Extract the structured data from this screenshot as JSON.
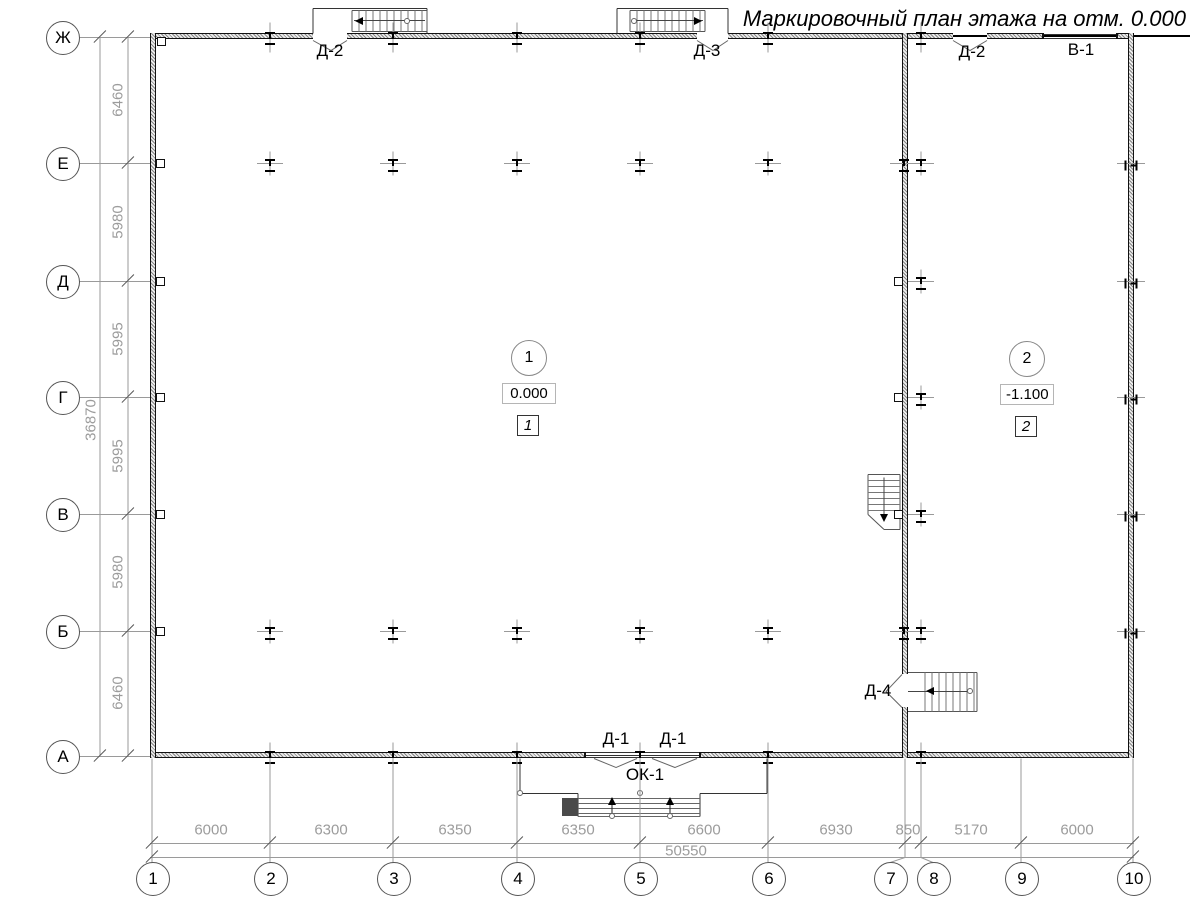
{
  "title": "Маркировочный план этажа на отм. 0.000",
  "axes": {
    "rows": [
      {
        "label": "Ж"
      },
      {
        "label": "Е"
      },
      {
        "label": "Д"
      },
      {
        "label": "Г"
      },
      {
        "label": "В"
      },
      {
        "label": "Б"
      },
      {
        "label": "А"
      }
    ],
    "cols": [
      {
        "label": "1"
      },
      {
        "label": "2"
      },
      {
        "label": "3"
      },
      {
        "label": "4"
      },
      {
        "label": "5"
      },
      {
        "label": "6"
      },
      {
        "label": "7"
      },
      {
        "label": "8"
      },
      {
        "label": "9"
      },
      {
        "label": "10"
      }
    ]
  },
  "dims": {
    "left_segments": [
      "6460",
      "5980",
      "5995",
      "5995",
      "5980",
      "6460"
    ],
    "left_total": "36870",
    "bottom_segments": [
      "6000",
      "6300",
      "6350",
      "6350",
      "6600",
      "6930",
      "850",
      "5170",
      "6000"
    ],
    "bottom_total": "50550"
  },
  "openings": {
    "top_left_door": "Д-2",
    "top_mid_door": "Д-3",
    "top_right_door": "Д-2",
    "gate": "В-1",
    "bottom_door_1": "Д-1",
    "bottom_door_2": "Д-1",
    "window": "ОК-1",
    "side_door": "Д-4"
  },
  "rooms": [
    {
      "number": "1",
      "elevation": "0.000",
      "tag": "1"
    },
    {
      "number": "2",
      "elevation": "-1.100",
      "tag": "2"
    }
  ],
  "colors": {
    "line": "#111111",
    "dim_text": "#9c9c9c",
    "background": "#ffffff"
  }
}
